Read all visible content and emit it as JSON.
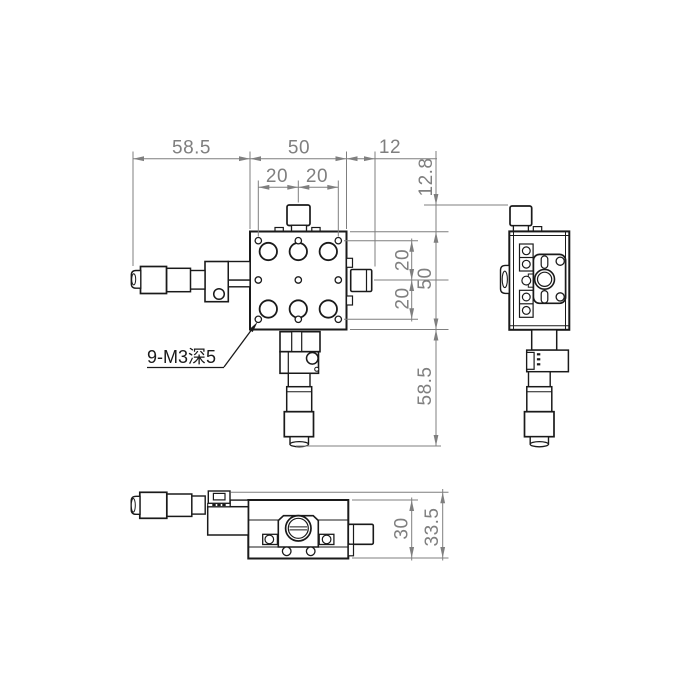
{
  "drawing": {
    "label_9m3": "9-M3深5",
    "dims": {
      "top_58_5": "58.5",
      "top_50": "50",
      "top_12": "12",
      "top_20a": "20",
      "top_20b": "20",
      "right_12_8": "12.8",
      "right_20a": "20",
      "right_20b": "20",
      "right_50": "50",
      "right_58_5": "58.5",
      "bottom_30": "30",
      "bottom_33_5": "33.5"
    },
    "colors": {
      "outline": "#1a1a1a",
      "dimension": "#7f7f7f",
      "background": "#ffffff"
    }
  }
}
